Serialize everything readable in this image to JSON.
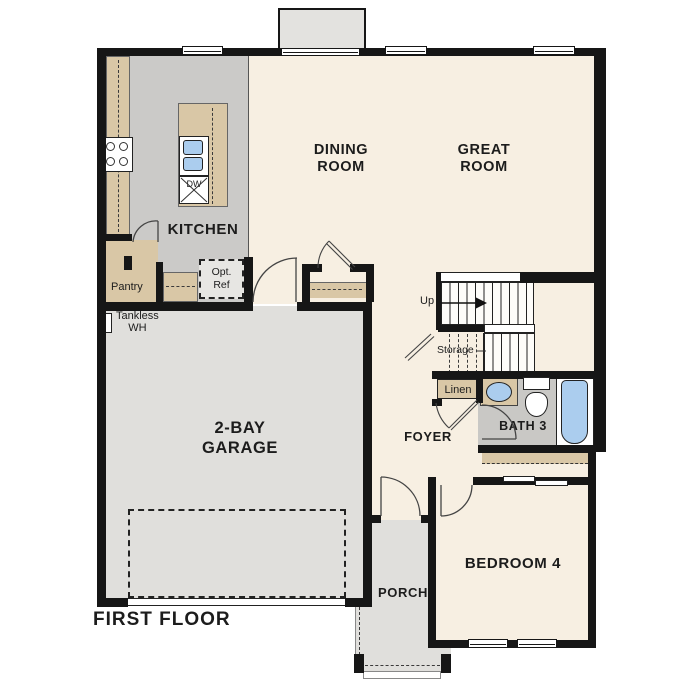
{
  "title": "FIRST FLOOR",
  "colors": {
    "wall": "#161616",
    "cream": "#f7efe2",
    "gray_light": "#e0dfdc",
    "gray_mid": "#cbcac8",
    "tan": "#d9c7a6",
    "blue": "#abcdee",
    "bath_gray": "#c9c8c5"
  },
  "rooms": {
    "kitchen": {
      "label": "KITCHEN"
    },
    "dining": {
      "line1": "DINING",
      "line2": "ROOM"
    },
    "great": {
      "line1": "GREAT",
      "line2": "ROOM"
    },
    "garage": {
      "line1": "2-BAY",
      "line2": "GARAGE"
    },
    "foyer": {
      "label": "FOYER"
    },
    "bath": {
      "label": "BATH 3"
    },
    "bedroom": {
      "label": "BEDROOM 4"
    },
    "porch": {
      "label": "PORCH"
    }
  },
  "features": {
    "pantry": "Pantry",
    "opt_ref_line1": "Opt.",
    "opt_ref_line2": "Ref",
    "tankless_line1": "Tankless",
    "tankless_line2": "WH",
    "dishwasher": "DW",
    "stairs_up": "Up",
    "storage": "Storage",
    "linen": "Linen"
  }
}
